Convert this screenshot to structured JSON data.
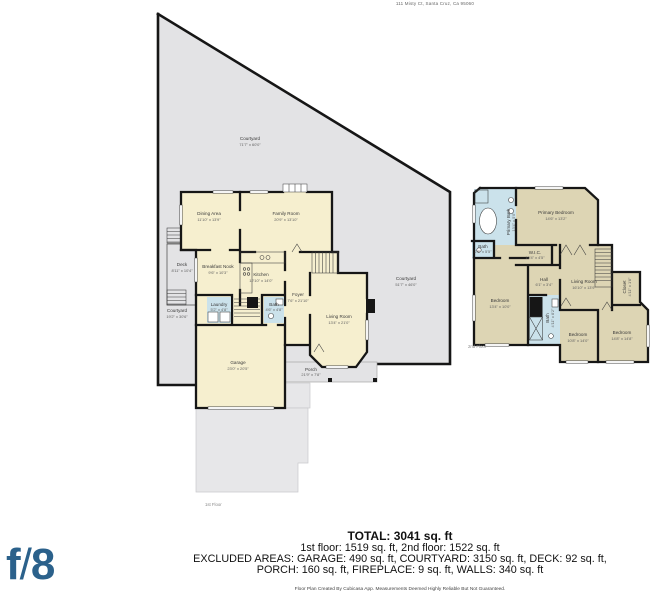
{
  "address": "111 Misty Ct, Santa Cruz, Ca 95060",
  "logo": {
    "f": "f",
    "slash": "/",
    "eight": "8"
  },
  "floor1": {
    "label": "1st Floor",
    "courtyard_main": {
      "name": "Courtyard",
      "dims": "71'7\" x 60'0\""
    },
    "courtyard_left": {
      "name": "Courtyard",
      "dims": "19'2\" x 30'6\""
    },
    "courtyard_right": {
      "name": "Courtyard",
      "dims": "51'7\" x 46'0\""
    },
    "dining": {
      "name": "Dining Area",
      "dims": "11'10\" x 13'9\""
    },
    "family": {
      "name": "Family Room",
      "dims": "20'9\" x 13'10\""
    },
    "deck": {
      "name": "Deck",
      "dims": "8'11\" x 10'4\""
    },
    "breakfast": {
      "name": "Breakfast Nook",
      "dims": "9'6\" x 10'3\""
    },
    "kitchen": {
      "name": "Kitchen",
      "dims": "12'10\" x 14'0\""
    },
    "laundry": {
      "name": "Laundry",
      "dims": "5'2\" x 4'8\""
    },
    "bath": {
      "name": "Bath",
      "dims": "4'6\" x 4'8\""
    },
    "foyer": {
      "name": "Foyer",
      "dims": "7'6\" x 21'10\""
    },
    "living": {
      "name": "Living Room",
      "dims": "13'4\" x 21'0\""
    },
    "garage": {
      "name": "Garage",
      "dims": "23'0\" x 20'5\""
    },
    "porch": {
      "name": "Porch",
      "dims": "21'9\" x 7'8\""
    }
  },
  "floor2": {
    "label": "2nd Floor",
    "primary_bath": {
      "name": "Primary Bath",
      "dims": "13'4\" x 5'0\""
    },
    "primary_bedroom": {
      "name": "Primary Bedroom",
      "dims": "14'6\" x 13'2\""
    },
    "bath_small": {
      "name": "Bath",
      "dims": "2'8\" x 5'5\""
    },
    "wic": {
      "name": "W.I.C.",
      "dims": "10'4\" x 4'5\""
    },
    "hall": {
      "name": "Hall",
      "dims": "6'1\" x 3'4\""
    },
    "living": {
      "name": "Living Room",
      "dims": "16'10\" x 13'9\""
    },
    "closet": {
      "name": "Closet",
      "dims": "4'11\" x 1'8\""
    },
    "bedroom_left": {
      "name": "Bedroom",
      "dims": "13'4\" x 10'0\""
    },
    "bath_mid": {
      "name": "Bath",
      "dims": "4'11\" x 8'2\""
    },
    "bedroom_mid": {
      "name": "Bedroom",
      "dims": "10'8\" x 14'0\""
    },
    "bedroom_right": {
      "name": "Bedroom",
      "dims": "14'8\" x 14'8\""
    }
  },
  "summary": {
    "total": "TOTAL: 3041 sq. ft",
    "floors_line": "1st floor: 1519 sq. ft, 2nd floor: 1522 sq. ft",
    "excluded_line1": "EXCLUDED AREAS: GARAGE: 490 sq. ft, COURTYARD: 3150 sq. ft, DECK: 92 sq. ft,",
    "excluded_line2": "PORCH: 160 sq. ft, FIREPLACE: 9 sq. ft, WALLS: 340 sq. ft",
    "disclaimer": "Floor Plan Created By Cubicasa App. Measurements Deemed Highly Reliable But Not Guaranteed."
  }
}
